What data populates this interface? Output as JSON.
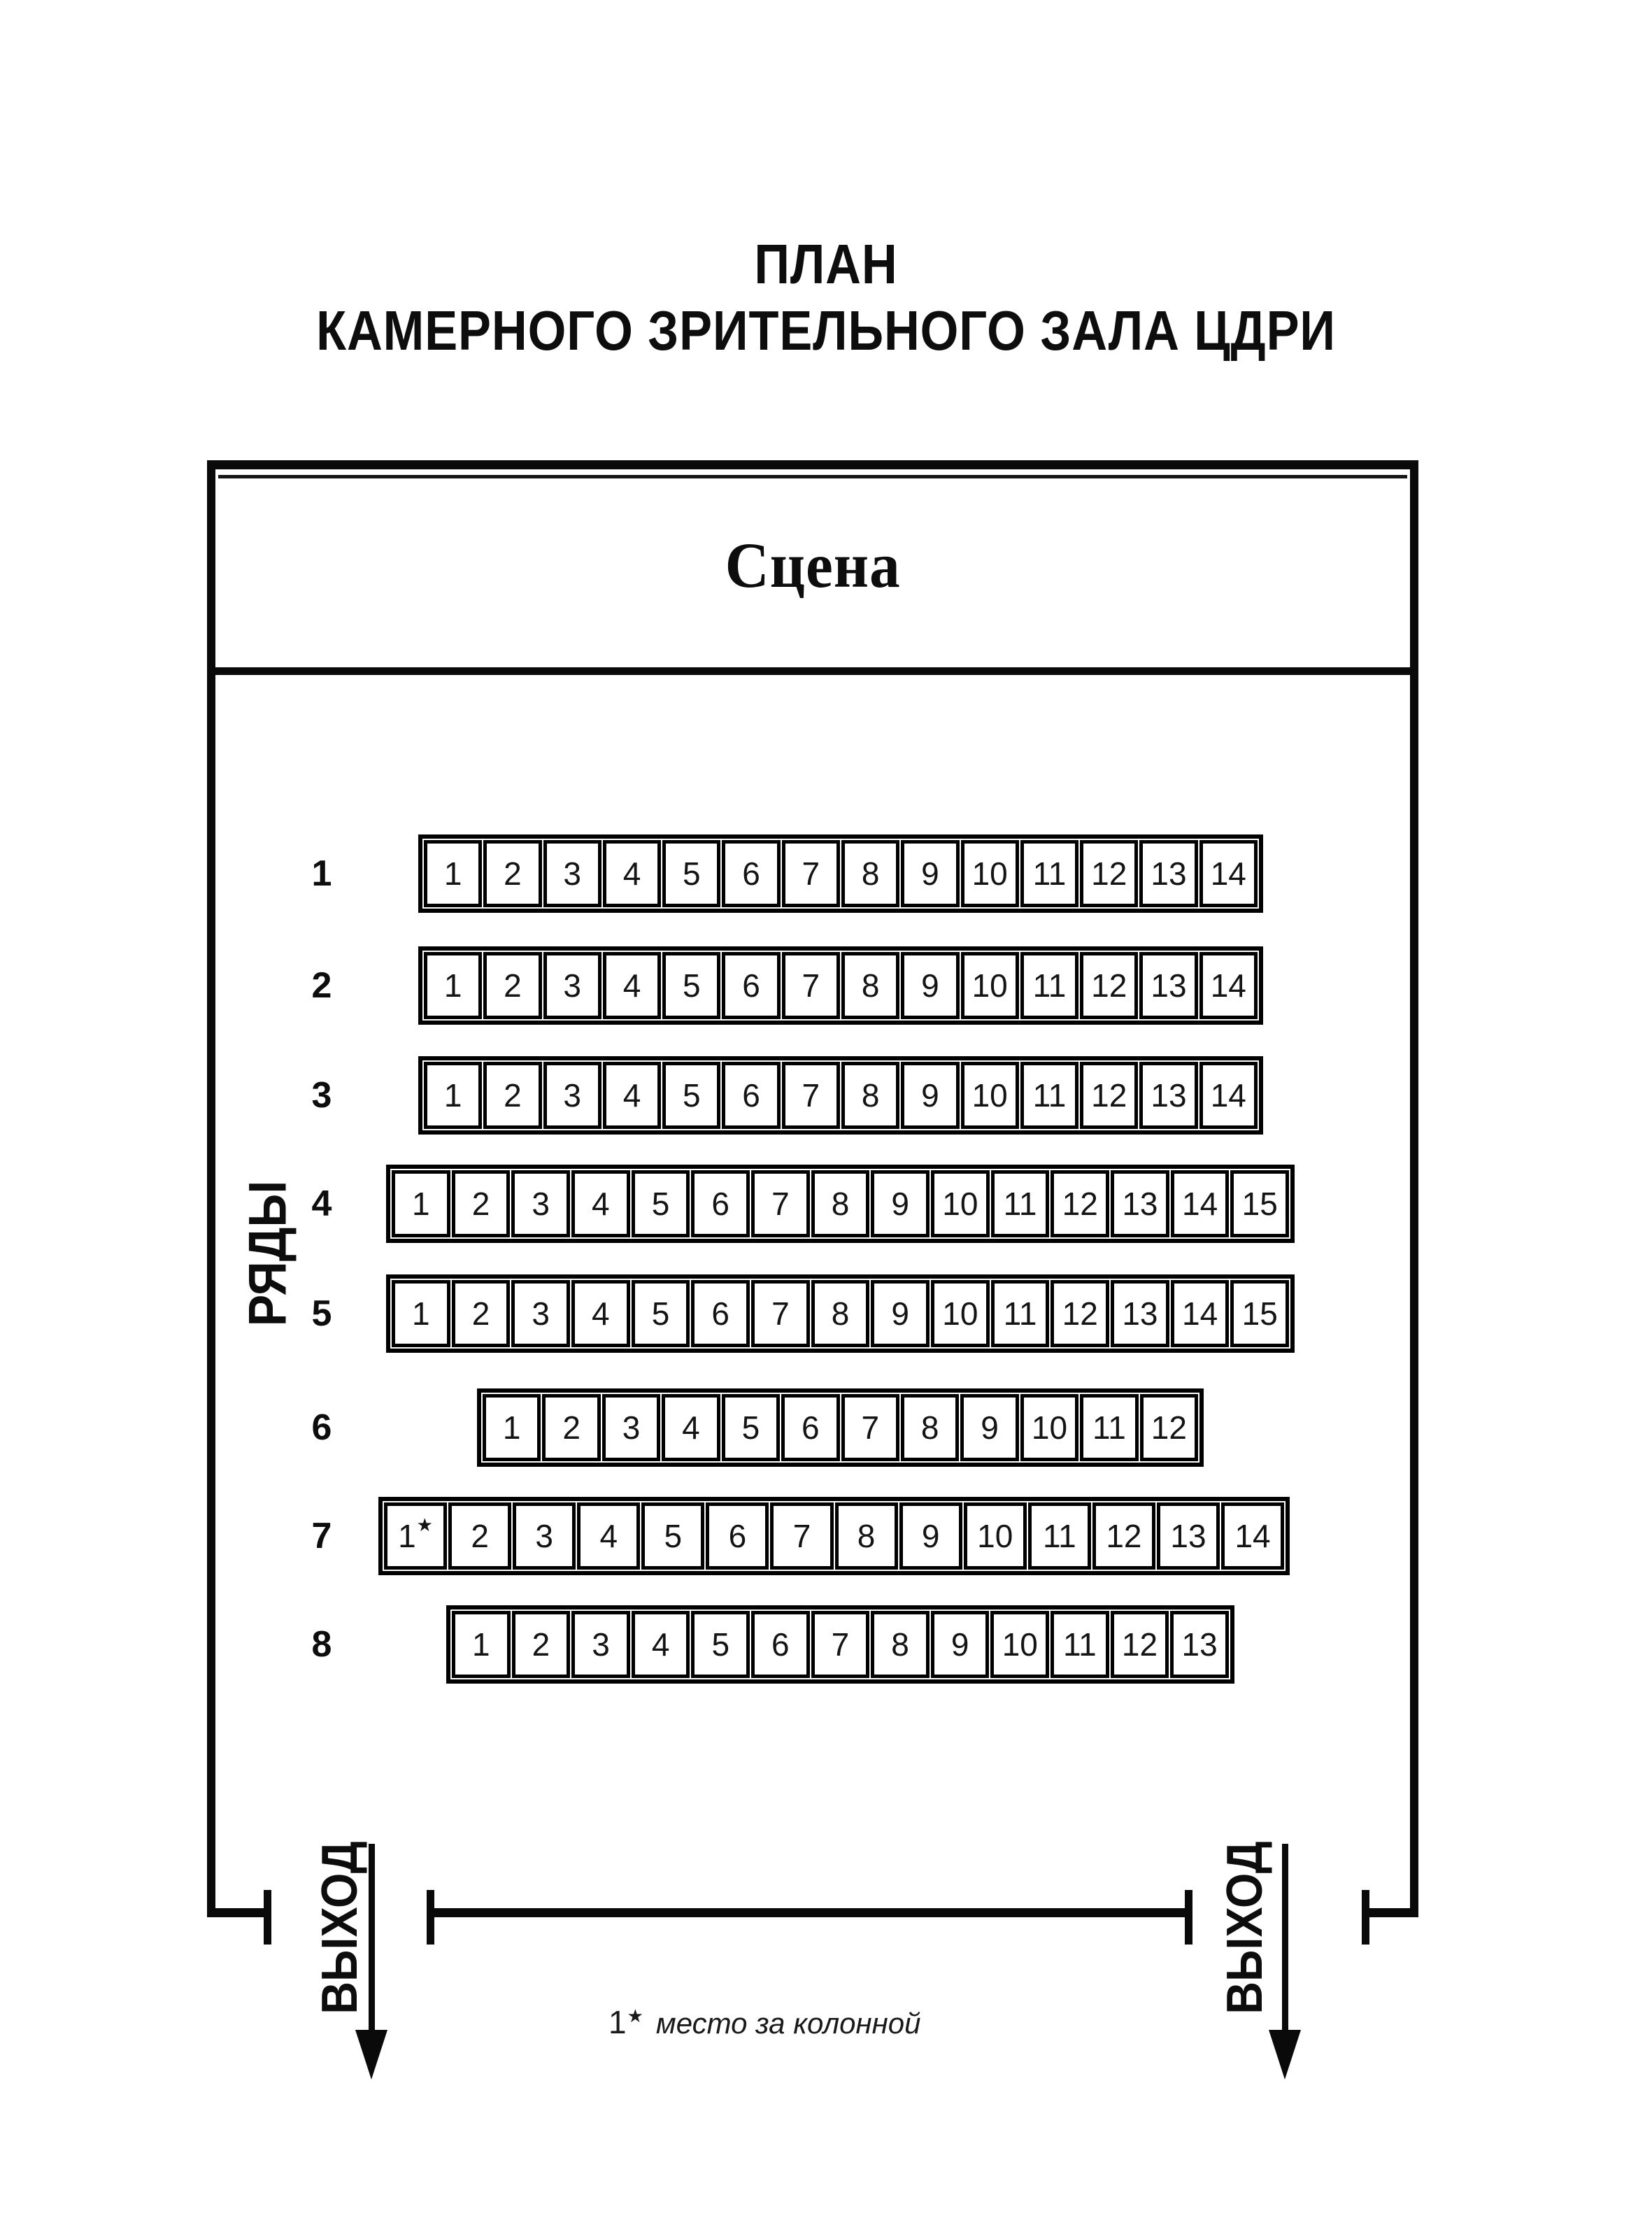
{
  "title": {
    "line1": "ПЛАН",
    "line2": "КАМЕРНОГО ЗРИТЕЛЬНОГО ЗАЛА ЦДРИ"
  },
  "stage": {
    "label": "Сцена"
  },
  "axis": {
    "rows_label": "РЯДЫ"
  },
  "exits": {
    "left": "ВЫХОД",
    "right": "ВЫХОД"
  },
  "footnote": {
    "marker": "1★",
    "text": "место за колонной"
  },
  "colors": {
    "ink": "#0a0a0a",
    "background": "#ffffff"
  },
  "rows": [
    {
      "label": "1",
      "seats": [
        "1",
        "2",
        "3",
        "4",
        "5",
        "6",
        "7",
        "8",
        "9",
        "10",
        "11",
        "12",
        "13",
        "14"
      ]
    },
    {
      "label": "2",
      "seats": [
        "1",
        "2",
        "3",
        "4",
        "5",
        "6",
        "7",
        "8",
        "9",
        "10",
        "11",
        "12",
        "13",
        "14"
      ]
    },
    {
      "label": "3",
      "seats": [
        "1",
        "2",
        "3",
        "4",
        "5",
        "6",
        "7",
        "8",
        "9",
        "10",
        "11",
        "12",
        "13",
        "14"
      ]
    },
    {
      "label": "4",
      "seats": [
        "1",
        "2",
        "3",
        "4",
        "5",
        "6",
        "7",
        "8",
        "9",
        "10",
        "11",
        "12",
        "13",
        "14",
        "15"
      ]
    },
    {
      "label": "5",
      "seats": [
        "1",
        "2",
        "3",
        "4",
        "5",
        "6",
        "7",
        "8",
        "9",
        "10",
        "11",
        "12",
        "13",
        "14",
        "15"
      ]
    },
    {
      "label": "6",
      "seats": [
        "1",
        "2",
        "3",
        "4",
        "5",
        "6",
        "7",
        "8",
        "9",
        "10",
        "11",
        "12"
      ]
    },
    {
      "label": "7",
      "seats": [
        "1★",
        "2",
        "3",
        "4",
        "5",
        "6",
        "7",
        "8",
        "9",
        "10",
        "11",
        "12",
        "13",
        "14"
      ]
    },
    {
      "label": "8",
      "seats": [
        "1",
        "2",
        "3",
        "4",
        "5",
        "6",
        "7",
        "8",
        "9",
        "10",
        "11",
        "12",
        "13"
      ]
    }
  ]
}
